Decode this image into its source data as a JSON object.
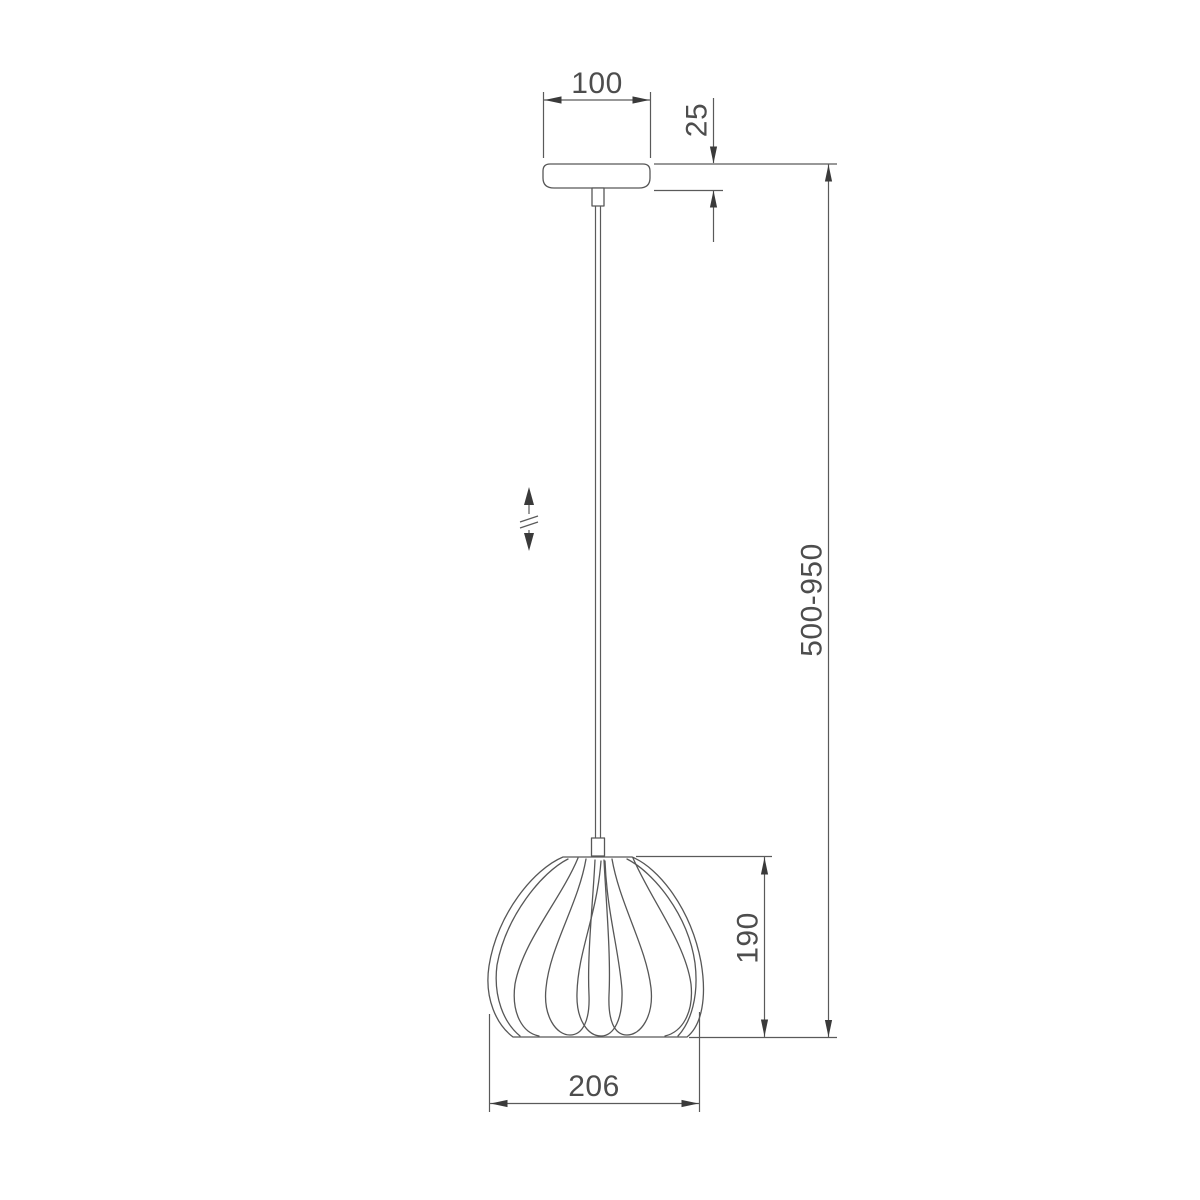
{
  "page": {
    "kind": "technical dimension drawing",
    "subject": "pendant lamp with petal-shaped shade"
  },
  "drawing": {
    "colors": {
      "background": "#ffffff",
      "line": "#575757",
      "arrow": "#3a3a3a",
      "text": "#4d4d4d"
    },
    "dimensions": {
      "canopy_width": {
        "label": "100"
      },
      "canopy_height": {
        "label": "25"
      },
      "suspension_height_range": {
        "label": "500-950"
      },
      "shade_height": {
        "label": "190"
      },
      "shade_diameter": {
        "label": "206"
      }
    },
    "icons": {
      "height_adjust": "double-headed-vertical-arrow-with-break-marks"
    }
  }
}
